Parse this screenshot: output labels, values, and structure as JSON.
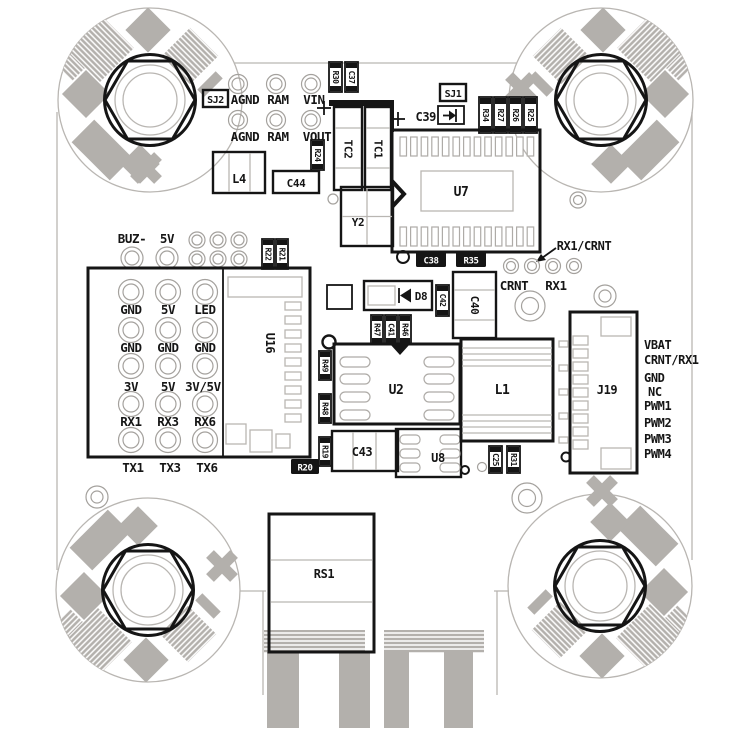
{
  "diagram_title": "flight-controller-pcb-layout",
  "colors": {
    "silkscreen": "#151515",
    "copper_gray": "#b3b0ac",
    "outline_gray": "#b9b6b2",
    "background": "#ffffff"
  },
  "refs": {
    "sj2": "SJ2",
    "sj1": "SJ1",
    "r30": "R30",
    "c37": "C37",
    "r24": "R24",
    "l4": "L4",
    "c44": "C44",
    "tc2": "TC2",
    "tc1": "TC1",
    "c39": "C39",
    "r34": "R34",
    "r27": "R27",
    "r26": "R26",
    "r25": "R25",
    "u7": "U7",
    "y2": "Y2",
    "c38": "C38",
    "r35": "R35",
    "r22": "R22",
    "r21": "R21",
    "u16": "U16",
    "d8": "D8",
    "c42": "C42",
    "c40": "C40",
    "r47": "R47",
    "c41": "C41",
    "r46": "R46",
    "r49": "R49",
    "r48": "R48",
    "r19": "R19",
    "u2": "U2",
    "c43": "C43",
    "u8": "U8",
    "r20": "R20",
    "c25": "C25",
    "r31": "R31",
    "l1": "L1",
    "j19": "J19",
    "rs1": "RS1"
  },
  "top_pads": {
    "row1": [
      "AGND",
      "RAM",
      "VIN"
    ],
    "row2": [
      "AGND",
      "RAM",
      "VOUT"
    ]
  },
  "aux": {
    "buz": "BUZ-",
    "v5": "5V"
  },
  "notes": {
    "rx1_crnt": "RX1/CRNT",
    "crnt": "CRNT",
    "rx1": "RX1"
  },
  "u16_grid": {
    "rows": [
      [
        "GND",
        "5V",
        "LED"
      ],
      [
        "GND",
        "GND",
        "GND"
      ],
      [
        "3V",
        "5V",
        "3V/5V"
      ],
      [
        "RX1",
        "RX3",
        "RX6"
      ],
      [
        "TX1",
        "TX3",
        "TX6"
      ]
    ]
  },
  "j19_pins": [
    "VBAT",
    "CRNT/RX1",
    "GND",
    "NC",
    "PWM1",
    "PWM2",
    "PWM3",
    "PWM4"
  ]
}
